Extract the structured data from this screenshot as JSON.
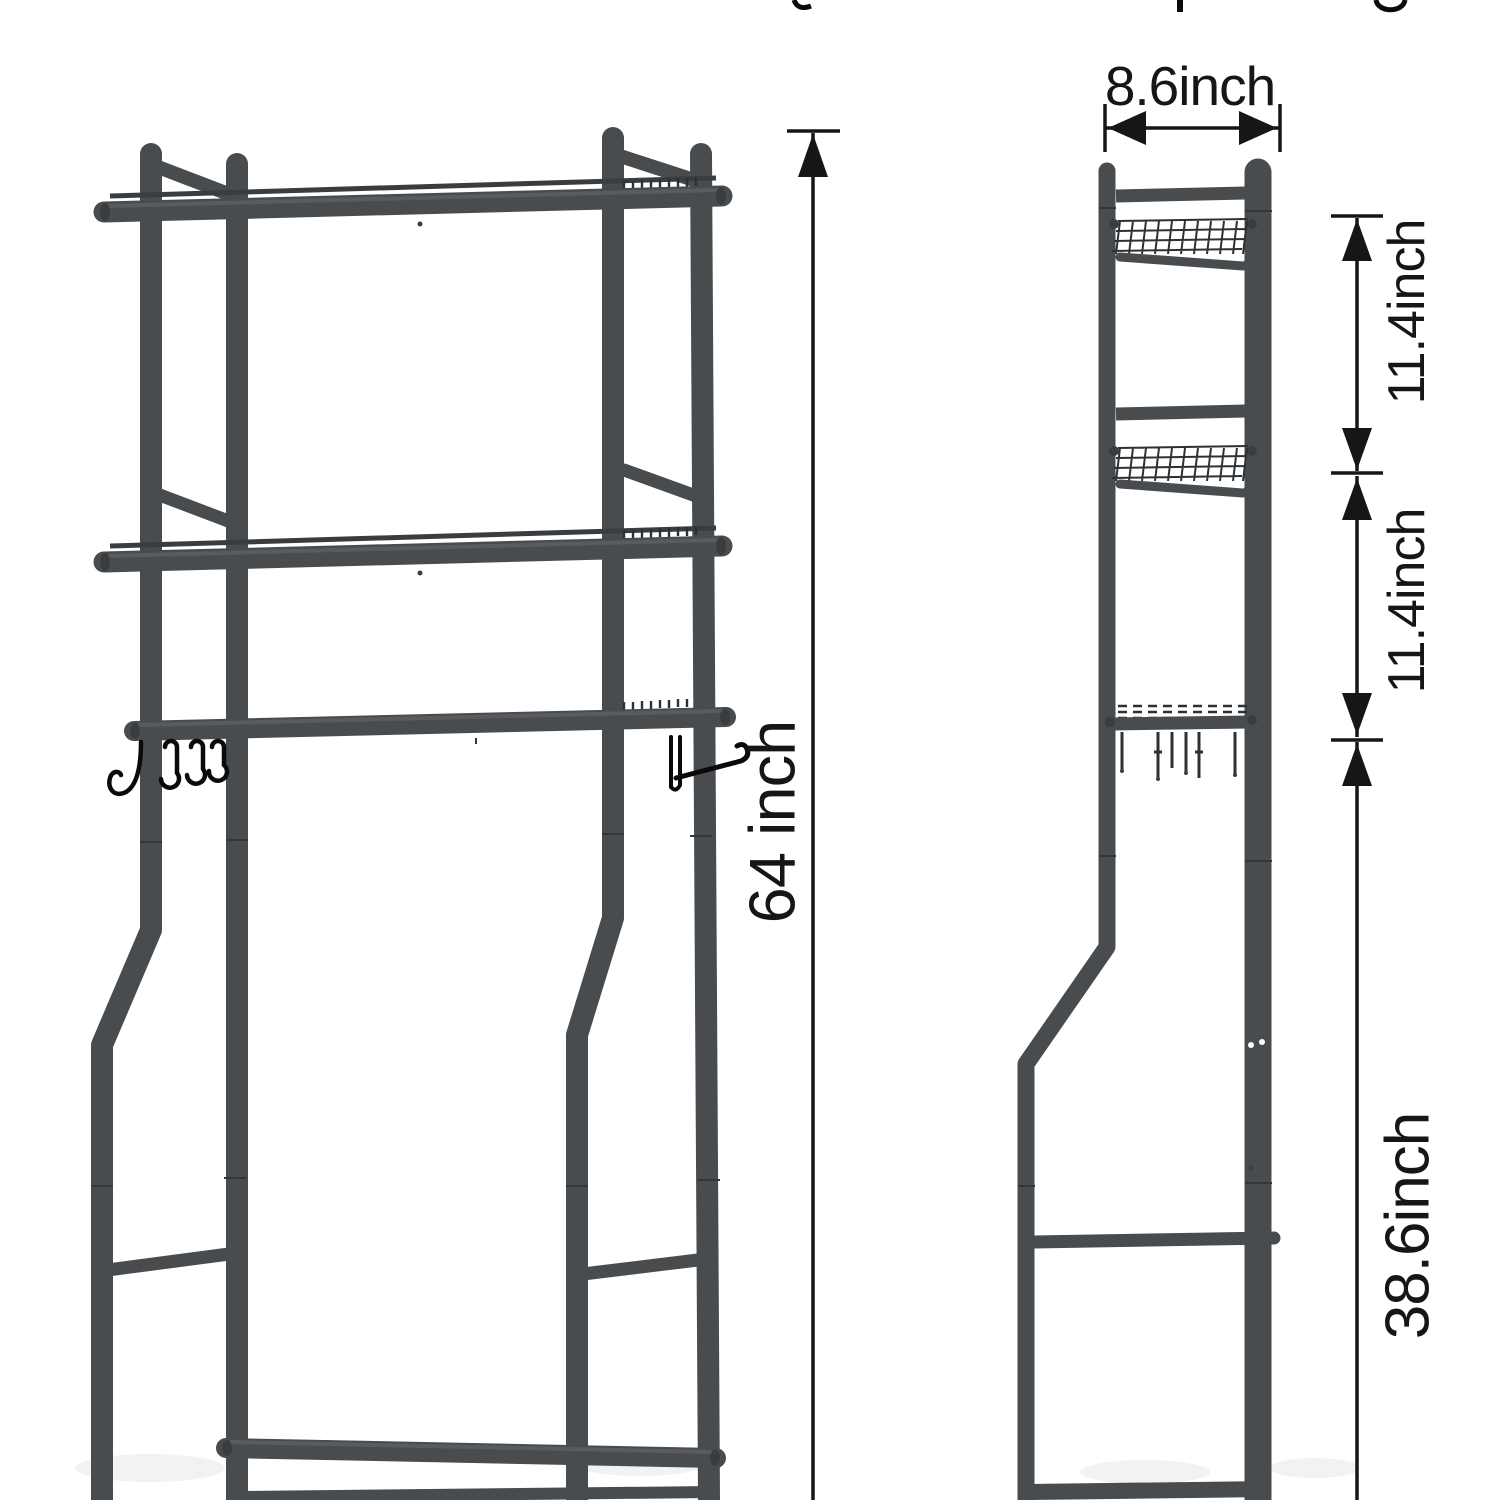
{
  "meta": {
    "colors": {
      "bg": "#ffffff",
      "tube": "#494c4f",
      "tube-dark": "#3a3d40",
      "tube-light": "#5d6064",
      "wire": "#2e3134",
      "ink": "#161616"
    }
  },
  "diagram": {
    "type": "product-dimension-diagram",
    "views": [
      {
        "id": "front-view",
        "description": "over-toilet rack front view with three cross rails, S-hooks and paper holder"
      },
      {
        "id": "side-view",
        "description": "over-toilet rack side profile with two wire baskets, hook rail and forward-kicked leg"
      }
    ],
    "dimensions": {
      "top_depth": "8.6inch",
      "total_height": "64 inch",
      "upper_shelf_gap": "11.4inch",
      "lower_shelf_gap": "11.4inch",
      "clearance_height": "38.6inch"
    }
  }
}
